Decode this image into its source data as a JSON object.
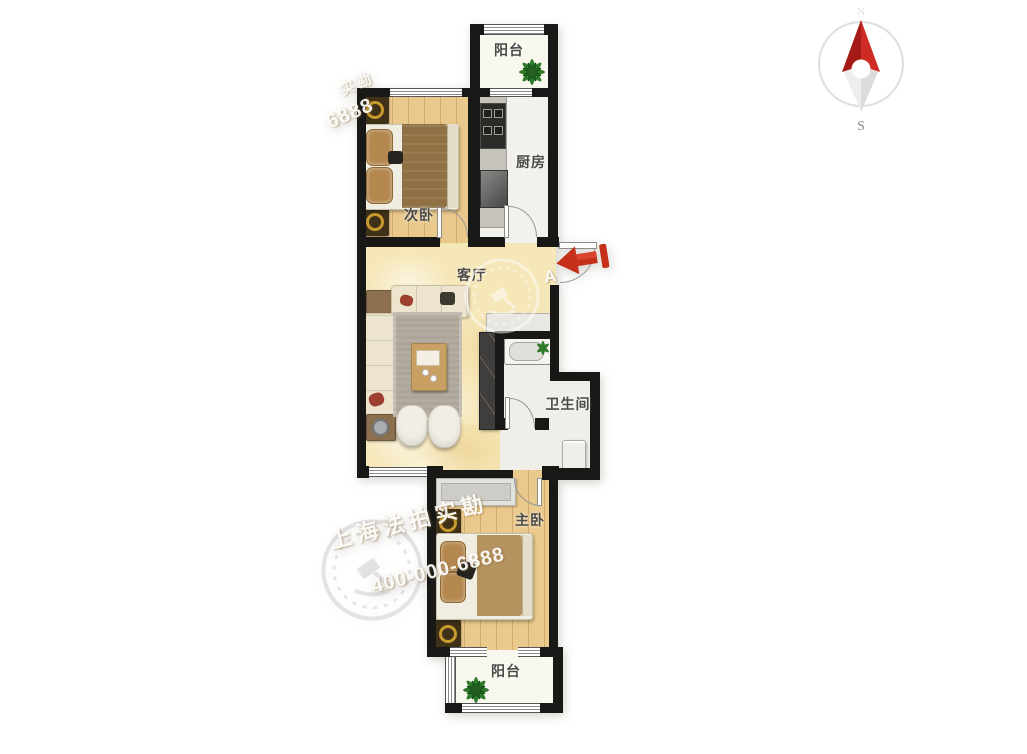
{
  "rooms": {
    "balcony_top": "阳台",
    "kitchen": "厨房",
    "bedroom_second": "次卧",
    "living": "客厅",
    "bathroom": "卫生间",
    "bedroom_master": "主卧",
    "balcony_bottom": "阳台"
  },
  "compass": {
    "north": "N",
    "south": "S"
  },
  "watermarks": {
    "agency": "上海法拍实勘",
    "phone": "400-000-6888",
    "phone_partial_top": "6888",
    "agency_partial_top": "实勘",
    "letter": "A"
  },
  "colors": {
    "wall": "#181816",
    "wood_floor": "#eac98c",
    "marble_floor": "#f6e7b8",
    "entry_arrow_red": "#c62f1a",
    "compass_red": "#ce2b24"
  }
}
